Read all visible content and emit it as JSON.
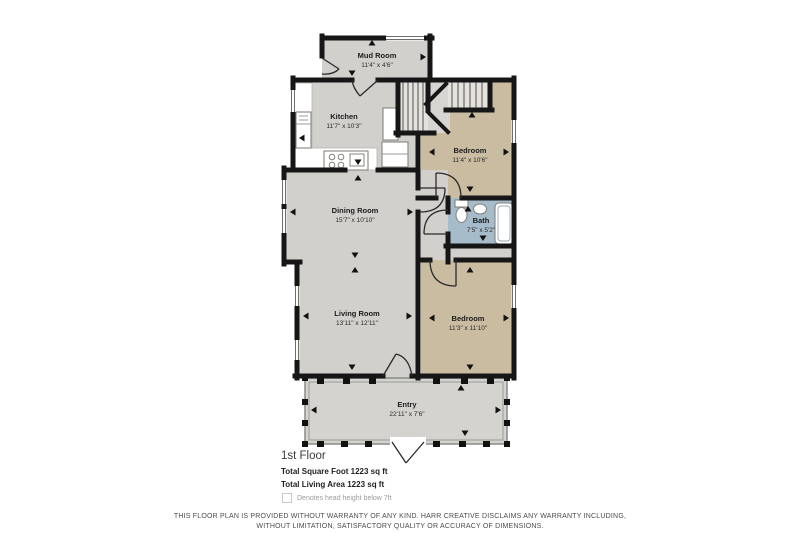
{
  "page": {
    "colors": {
      "wall": "#161616",
      "floor_gray": "#d2d0cc",
      "floor_tan": "#c9bca1",
      "bath_blue": "#a6bcca",
      "porch_gray": "#d4d3cf"
    },
    "rooms": [
      {
        "name": "Mud Room",
        "dims": "11'4\" x 4'6\""
      },
      {
        "name": "Kitchen",
        "dims": "11'7\" x 10'3\""
      },
      {
        "name": "Bedroom",
        "dims": "11'4\" x 10'6\""
      },
      {
        "name": "Dining Room",
        "dims": "15'7\" x 10'10\""
      },
      {
        "name": "Bath",
        "dims": "7'5\" x 5'2\""
      },
      {
        "name": "Living Room",
        "dims": "13'11\" x 12'11\""
      },
      {
        "name": "Bedroom",
        "dims": "11'3\" x 11'10\""
      },
      {
        "name": "Entry",
        "dims": "22'11\" x 7'6\""
      }
    ],
    "footer": {
      "floor_label": "1st Floor",
      "total_square": "Total Square Foot 1223 sq ft",
      "total_living": "Total Living Area 1223 sq ft",
      "legend_note": "Denotes head height below 7ft",
      "disclaimer_line1": "THIS FLOOR PLAN IS PROVIDED WITHOUT WARRANTY OF ANY KIND. HARR CREATIVE DISCLAIMS ANY WARRANTY INCLUDING,",
      "disclaimer_line2": "WITHOUT LIMITATION, SATISFACTORY QUALITY OR ACCURACY OF DIMENSIONS."
    }
  }
}
